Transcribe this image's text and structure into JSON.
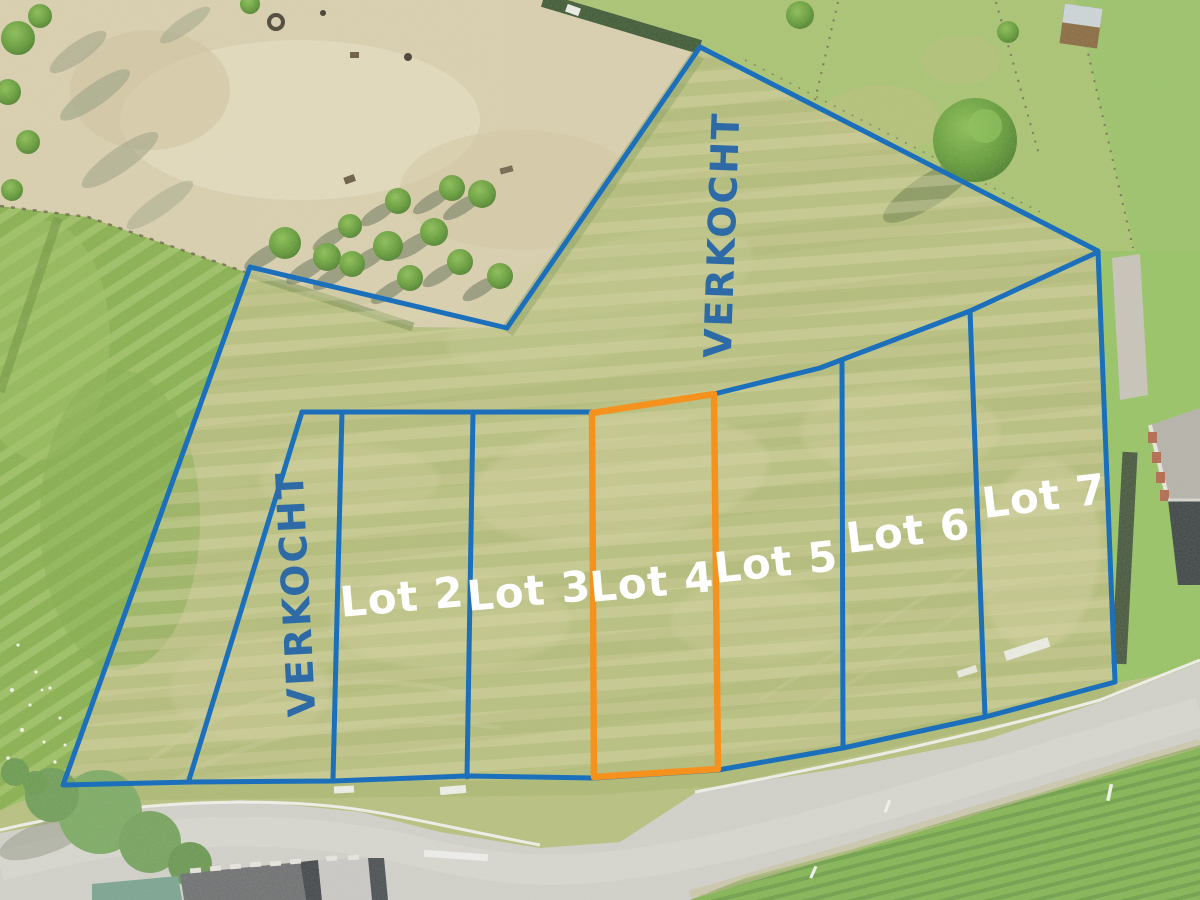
{
  "canvas": {
    "width_px": 1200,
    "height_px": 900
  },
  "overlay": {
    "sold_label_top": "VERKOCHT",
    "sold_label_left": "VERKOCHT",
    "highlighted_lot": "Lot 4",
    "lot_labels": [
      {
        "id": "lot-2",
        "label": "Lot 2"
      },
      {
        "id": "lot-3",
        "label": "Lot 3"
      },
      {
        "id": "lot-4",
        "label": "Lot 4"
      },
      {
        "id": "lot-5",
        "label": "Lot 5"
      },
      {
        "id": "lot-6",
        "label": "Lot 6"
      },
      {
        "id": "lot-7",
        "label": "Lot 7"
      }
    ]
  },
  "colors": {
    "boundary_blue": "#1c6fbb",
    "sold_text_blue": "#2e6ba6",
    "highlight_orange": "#f5921e",
    "lot_text_white": "#ffffff"
  }
}
